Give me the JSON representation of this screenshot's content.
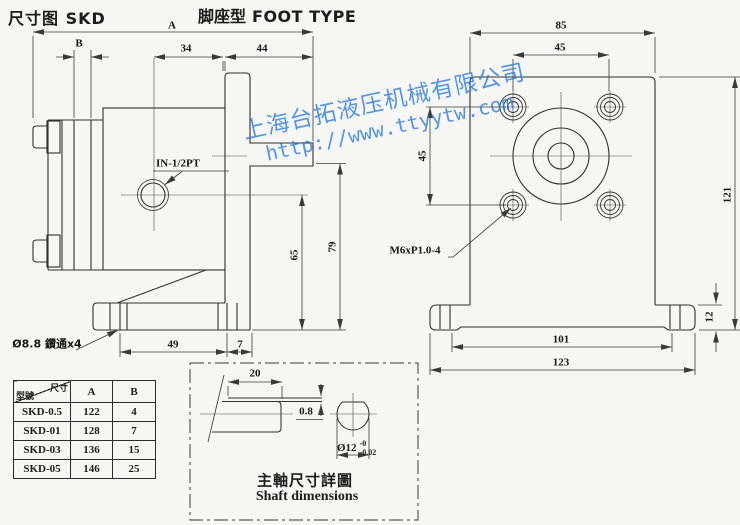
{
  "page": {
    "title_left": "尺寸图 SKD",
    "title_center_cn": "脚座型",
    "title_center_en": "FOOT TYPE"
  },
  "watermark": {
    "company": "上海台拓液压机械有限公司",
    "url": "http://www.ttyytw.com",
    "color": "#2e7ce0"
  },
  "side_view": {
    "dims": {
      "a": "A",
      "b": "B",
      "d34": "34",
      "d44": "44",
      "d65": "65",
      "d79": "79",
      "d49": "49",
      "d7": "7"
    },
    "labels": {
      "inlet_port": "IN-1/2PT",
      "foot_holes": "Ø8.8 鑽通x4"
    }
  },
  "front_view": {
    "dims": {
      "d85": "85",
      "d45_top": "45",
      "d45_left": "45",
      "d121": "121",
      "d12": "12",
      "d101": "101",
      "d123": "123"
    },
    "labels": {
      "mounting_thread": "M6xP1.0-4"
    }
  },
  "detail_box": {
    "dims": {
      "d20": "20",
      "d08": "0.8",
      "d12": "Ø12",
      "tol_upper": "-0",
      "tol_lower": "-0.02"
    },
    "caption_cn": "主軸尺寸詳圖",
    "caption_en": "Shaft dimensions"
  },
  "spec_table": {
    "header": {
      "corner_top": "尺寸",
      "corner_bottom": "型號",
      "col_a": "A",
      "col_b": "B"
    },
    "rows": [
      {
        "model": "SKD-0.5",
        "a": "122",
        "b": "4"
      },
      {
        "model": "SKD-01",
        "a": "128",
        "b": "7"
      },
      {
        "model": "SKD-03",
        "a": "136",
        "b": "15"
      },
      {
        "model": "SKD-05",
        "a": "146",
        "b": "25"
      }
    ]
  }
}
